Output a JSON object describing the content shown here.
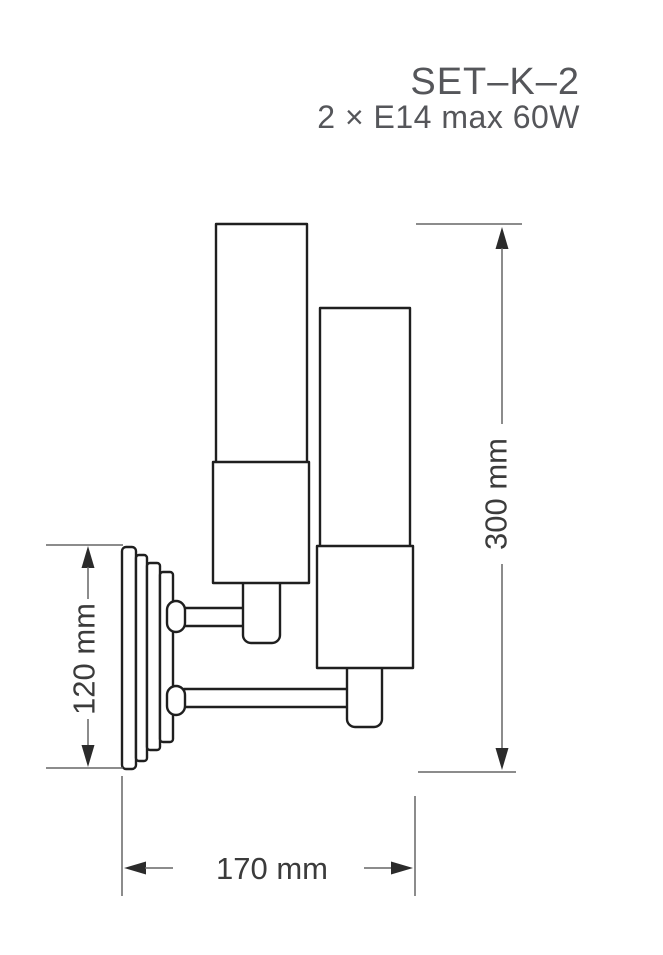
{
  "product": {
    "model": "SET–K–2",
    "spec": "2 × E14 max 60W"
  },
  "dimensions": {
    "total_height": "300 mm",
    "backplate_height": "120 mm",
    "total_width": "170 mm"
  },
  "drawing": {
    "type": "technical-line-drawing",
    "subject": "two-arm wall sconce with cylindrical glass shades"
  },
  "colors": {
    "line": "#1f1f1f",
    "dim_line": "#666666",
    "arrow": "#2b2b2b",
    "dim_text": "#3b3b3b",
    "heading_text": "#55565a",
    "bg": "#ffffff"
  }
}
